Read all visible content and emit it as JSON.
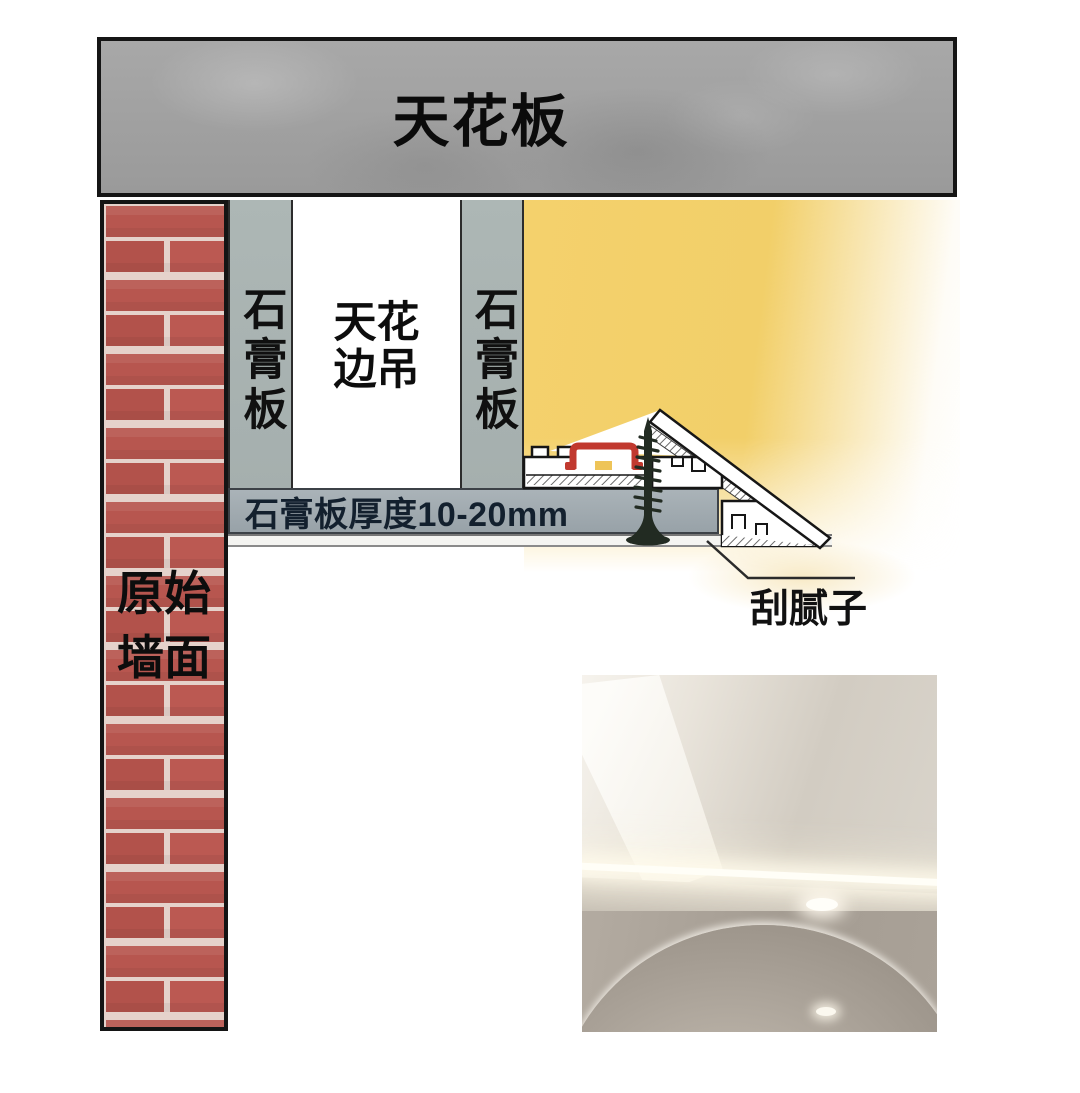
{
  "diagram": {
    "ceiling": {
      "label": "天花板"
    },
    "original_wall": {
      "label_lines": [
        "原始",
        "墙面"
      ]
    },
    "gypsum_board_left": {
      "label": "石膏板"
    },
    "ceiling_edge_drop": {
      "label_lines": [
        "天花",
        "边吊"
      ]
    },
    "gypsum_board_right": {
      "label": "石膏板"
    },
    "board_thickness_bar": {
      "label": "石膏板厚度10-20mm"
    },
    "putty_callout": {
      "label": "刮腻子"
    },
    "colors": {
      "concrete_gray": "#9f9f9f",
      "brick_red": "#b7564f",
      "mortar_white": "#e5d2cb",
      "gypsum_strip_gray": "#a9b3b1",
      "glow_yellow": "#f4d16c",
      "thickness_bar_gray": "#9fa9ae",
      "led_channel_red": "#c1392f",
      "led_light_yellow": "#eec458",
      "outline_black": "#161616",
      "screw_black": "#222b22"
    }
  }
}
